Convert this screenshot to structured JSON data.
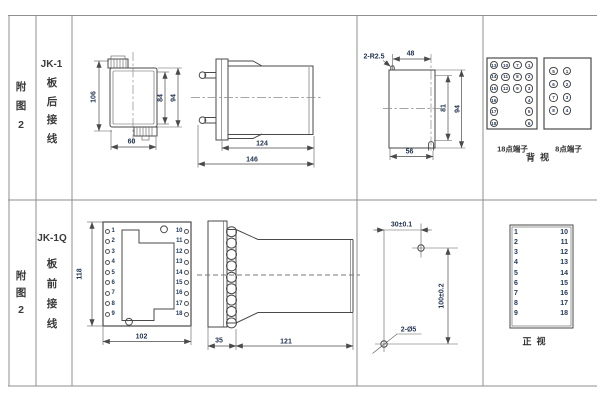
{
  "figure": {
    "row1": {
      "fig_label_chars": [
        "附",
        "图",
        "2"
      ],
      "model": "JK-1",
      "wiring_chars": [
        "板",
        "后",
        "接",
        "线"
      ],
      "dims": {
        "height_total": "106",
        "height_inner": "84",
        "height_case": "94",
        "width_case": "60",
        "depth_body": "124",
        "depth_total": "146",
        "notch_radius": "2-R2.5",
        "cutout_width_top": "48",
        "cutout_height_inner": "81",
        "cutout_height": "94",
        "cutout_width": "56"
      },
      "terminal18": {
        "label": "18点端子",
        "grid": [
          [
            "13",
            "10",
            "7",
            "1"
          ],
          [
            "14",
            "11",
            "8",
            "2"
          ],
          [
            "15",
            "12",
            "9",
            "3"
          ],
          [
            "16",
            "",
            "",
            "4"
          ],
          [
            "17",
            "",
            "",
            "5"
          ],
          [
            "18",
            "",
            "",
            "6"
          ]
        ]
      },
      "terminal8": {
        "label": "8点端子",
        "grid": [
          [
            "5",
            "1"
          ],
          [
            "6",
            "2"
          ],
          [
            "7",
            "3"
          ],
          [
            "8",
            "4"
          ]
        ]
      },
      "view_label": "背  视"
    },
    "row2": {
      "fig_label_chars": [
        "附",
        "图",
        "2"
      ],
      "model": "JK-1Q",
      "wiring_chars": [
        "板",
        "前",
        "接",
        "线"
      ],
      "dims": {
        "height": "118",
        "width": "102",
        "flange_depth": "35",
        "body_depth": "121",
        "hole_offset_x": "30±0.1",
        "hole_offset_y": "100±0.2",
        "hole_spec": "2-Ø5"
      },
      "socket_terminals": {
        "left": [
          "1",
          "2",
          "3",
          "4",
          "5",
          "6",
          "7",
          "8",
          "9"
        ],
        "right": [
          "10",
          "11",
          "12",
          "13",
          "14",
          "15",
          "16",
          "17",
          "18"
        ]
      },
      "terminal_table": {
        "left": [
          "1",
          "2",
          "3",
          "4",
          "5",
          "6",
          "7",
          "8",
          "9"
        ],
        "right": [
          "10",
          "11",
          "12",
          "13",
          "14",
          "15",
          "16",
          "17",
          "18"
        ]
      },
      "view_label": "正  视"
    }
  }
}
